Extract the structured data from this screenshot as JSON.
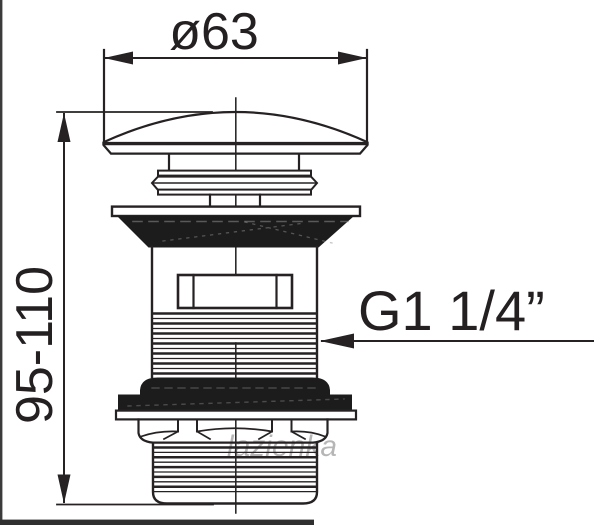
{
  "drawing": {
    "type": "technical-dimension-drawing",
    "subject": "pop-up (click-clack) basin waste drain valve, side view",
    "labels": {
      "diameter": "ø63",
      "height_range": "95-110",
      "thread_size": "G1 1/4”"
    },
    "dimensions": {
      "cap_diameter_mm": 63,
      "height_min_mm": 95,
      "height_max_mm": 110,
      "thread": "G1 1/4 inch"
    },
    "colors": {
      "background": "#ffffff",
      "line": "#262223",
      "gasket_fill": "#1c1c1c",
      "photo_edge": "#343434"
    },
    "watermark": "lazienka"
  }
}
